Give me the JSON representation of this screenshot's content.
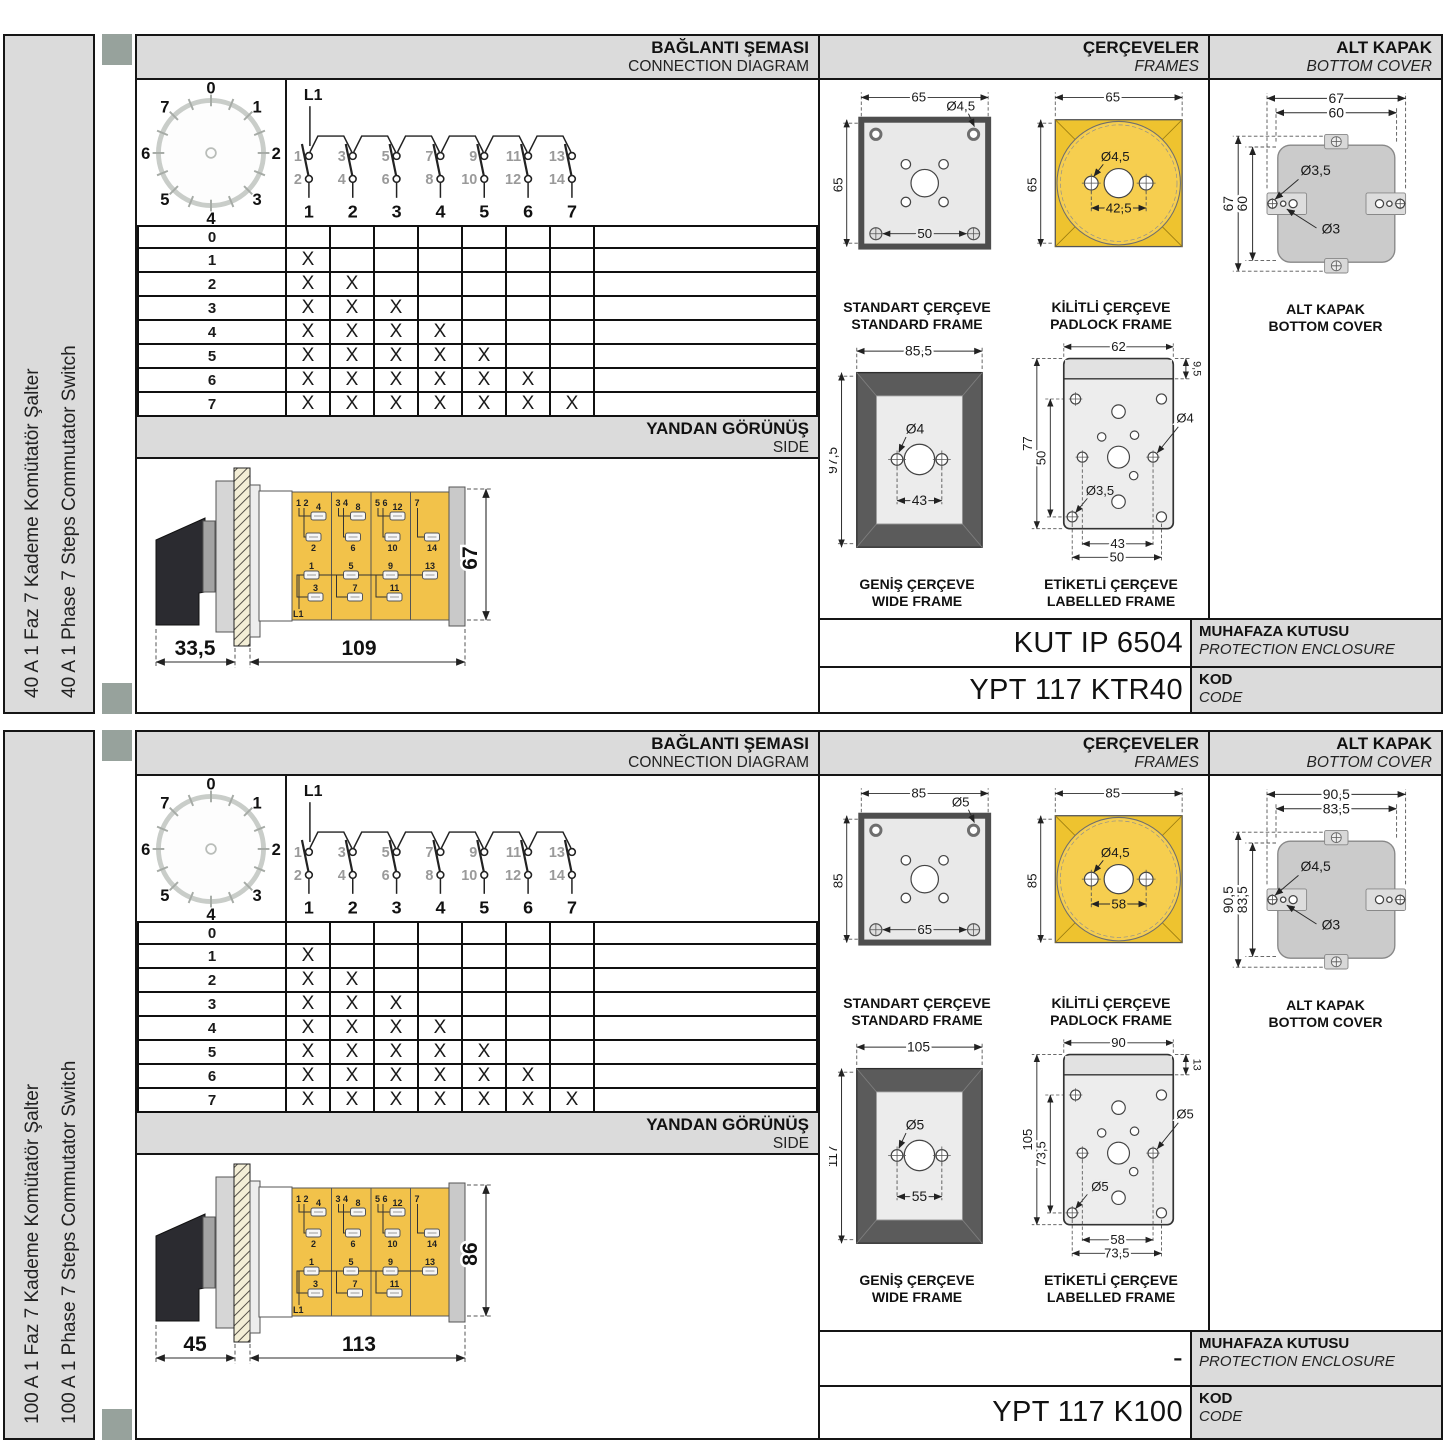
{
  "rows": [
    {
      "sidebar": {
        "title_tr": "40 A 1 Faz 7 Kademe Komütatör Şalter",
        "title_en": "40 A 1 Phase 7 Steps Commutator Switch"
      },
      "connection": {
        "header_tr": "BAĞLANTI ŞEMASI",
        "header_en": "CONNECTION DIAGRAM",
        "dial": {
          "labels": [
            "0",
            "1",
            "2",
            "3",
            "4",
            "5",
            "6",
            "7"
          ]
        },
        "contacts": {
          "line_label": "L1",
          "top_terminals": [
            "1",
            "3",
            "5",
            "7",
            "9",
            "11",
            "13"
          ],
          "bottom_terminals": [
            "2",
            "4",
            "6",
            "8",
            "10",
            "12",
            "14"
          ],
          "columns": [
            "1",
            "2",
            "3",
            "4",
            "5",
            "6",
            "7"
          ]
        },
        "step_table": {
          "row_labels": [
            "0",
            "1",
            "2",
            "3",
            "4",
            "5",
            "6",
            "7"
          ],
          "marks": [
            0,
            1,
            2,
            3,
            4,
            5,
            6,
            7
          ],
          "mark_symbol": "X",
          "columns": 7
        }
      },
      "side": {
        "header_tr": "YANDAN GÖRÜNÜŞ",
        "header_en": "SIDE",
        "dims": {
          "front": "33,5",
          "body": "109",
          "height": "67"
        },
        "terminals": {
          "bus": "L1",
          "sections": [
            {
              "pair": "1 2",
              "upper": "4",
              "mid": "2",
              "low_a": "1",
              "low_b": "3"
            },
            {
              "pair": "3 4",
              "upper": "8",
              "mid": "6",
              "low_a": "5",
              "low_b": "7"
            },
            {
              "pair": "5 6",
              "upper": "12",
              "mid": "10",
              "low_a": "9",
              "low_b": "11"
            },
            {
              "pair": "7",
              "upper": "",
              "mid": "14",
              "low_a": "13",
              "low_b": ""
            }
          ]
        }
      },
      "frames": {
        "header_tr": "ÇERÇEVELER",
        "header_en": "FRAMES",
        "standard": {
          "caption_tr": "STANDART ÇERÇEVE",
          "caption_en": "STANDARD FRAME",
          "width": "65",
          "height": "65",
          "hole": "Ø4,5",
          "pitch": "50"
        },
        "padlock": {
          "caption_tr": "KİLİTLİ ÇERÇEVE",
          "caption_en": "PADLOCK FRAME",
          "width": "65",
          "height": "65",
          "hole": "Ø4,5",
          "pitch": "42,5"
        },
        "wide": {
          "caption_tr": "GENİŞ ÇERÇEVE",
          "caption_en": "WIDE FRAME",
          "width": "85,5",
          "height": "97,5",
          "hole": "Ø4",
          "pitch": "43"
        },
        "labelled": {
          "caption_tr": "ETİKETLİ ÇERÇEVE",
          "caption_en": "LABELLED FRAME",
          "width": "62",
          "strip": "9,5",
          "height": "77",
          "inner_height": "50",
          "hole_side": "Ø4",
          "hole_corner": "Ø3,5",
          "pitch_inner": "43",
          "pitch_outer": "50"
        }
      },
      "cover": {
        "header_tr": "ALT KAPAK",
        "header_en": "BOTTOM COVER",
        "caption_tr": "ALT KAPAK",
        "caption_en": "BOTTOM COVER",
        "outer_w": "67",
        "inner_w": "60",
        "outer_h": "67",
        "inner_h": "60",
        "hole_big": "Ø3,5",
        "hole_small": "Ø3"
      },
      "codes": {
        "enclosure_value": "KUT IP 6504",
        "enclosure_label_tr": "MUHAFAZA KUTUSU",
        "enclosure_label_en": "PROTECTION ENCLOSURE",
        "code_value": "YPT 117 KTR40",
        "code_label_tr": "KOD",
        "code_label_en": "CODE"
      }
    },
    {
      "sidebar": {
        "title_tr": "100 A 1 Faz 7 Kademe Komütatör Şalter",
        "title_en": "100 A 1 Phase 7 Steps Commutator Switch"
      },
      "connection": {
        "header_tr": "BAĞLANTI ŞEMASI",
        "header_en": "CONNECTION DIAGRAM",
        "dial": {
          "labels": [
            "0",
            "1",
            "2",
            "3",
            "4",
            "5",
            "6",
            "7"
          ]
        },
        "contacts": {
          "line_label": "L1",
          "top_terminals": [
            "1",
            "3",
            "5",
            "7",
            "9",
            "11",
            "13"
          ],
          "bottom_terminals": [
            "2",
            "4",
            "6",
            "8",
            "10",
            "12",
            "14"
          ],
          "columns": [
            "1",
            "2",
            "3",
            "4",
            "5",
            "6",
            "7"
          ]
        },
        "step_table": {
          "row_labels": [
            "0",
            "1",
            "2",
            "3",
            "4",
            "5",
            "6",
            "7"
          ],
          "marks": [
            0,
            1,
            2,
            3,
            4,
            5,
            6,
            7
          ],
          "mark_symbol": "X",
          "columns": 7
        }
      },
      "side": {
        "header_tr": "YANDAN GÖRÜNÜŞ",
        "header_en": "SIDE",
        "dims": {
          "front": "45",
          "body": "113",
          "height": "86"
        },
        "terminals": {
          "bus": "L1",
          "sections": [
            {
              "pair": "1 2",
              "upper": "4",
              "mid": "2",
              "low_a": "1",
              "low_b": "3"
            },
            {
              "pair": "3 4",
              "upper": "8",
              "mid": "6",
              "low_a": "5",
              "low_b": "7"
            },
            {
              "pair": "5 6",
              "upper": "12",
              "mid": "10",
              "low_a": "9",
              "low_b": "11"
            },
            {
              "pair": "7",
              "upper": "",
              "mid": "14",
              "low_a": "13",
              "low_b": ""
            }
          ]
        }
      },
      "frames": {
        "header_tr": "ÇERÇEVELER",
        "header_en": "FRAMES",
        "standard": {
          "caption_tr": "STANDART ÇERÇEVE",
          "caption_en": "STANDARD FRAME",
          "width": "85",
          "height": "85",
          "hole": "Ø5",
          "pitch": "65"
        },
        "padlock": {
          "caption_tr": "KİLİTLİ ÇERÇEVE",
          "caption_en": "PADLOCK FRAME",
          "width": "85",
          "height": "85",
          "hole": "Ø4,5",
          "pitch": "58"
        },
        "wide": {
          "caption_tr": "GENİŞ ÇERÇEVE",
          "caption_en": "WIDE FRAME",
          "width": "105",
          "height": "117",
          "hole": "Ø5",
          "pitch": "55"
        },
        "labelled": {
          "caption_tr": "ETİKETLİ ÇERÇEVE",
          "caption_en": "LABELLED FRAME",
          "width": "90",
          "strip": "13",
          "height": "105",
          "inner_height": "73,5",
          "hole_side": "Ø5",
          "hole_corner": "Ø5",
          "pitch_inner": "58",
          "pitch_outer": "73,5"
        }
      },
      "cover": {
        "header_tr": "ALT KAPAK",
        "header_en": "BOTTOM COVER",
        "caption_tr": "ALT KAPAK",
        "caption_en": "BOTTOM COVER",
        "outer_w": "90,5",
        "inner_w": "83,5",
        "outer_h": "90,5",
        "inner_h": "83,5",
        "hole_big": "Ø4,5",
        "hole_small": "Ø3"
      },
      "codes": {
        "enclosure_value": "-",
        "enclosure_label_tr": "MUHAFAZA KUTUSU",
        "enclosure_label_en": "PROTECTION ENCLOSURE",
        "code_value": "YPT 117 K100",
        "code_label_tr": "KOD",
        "code_label_en": "CODE"
      }
    }
  ]
}
